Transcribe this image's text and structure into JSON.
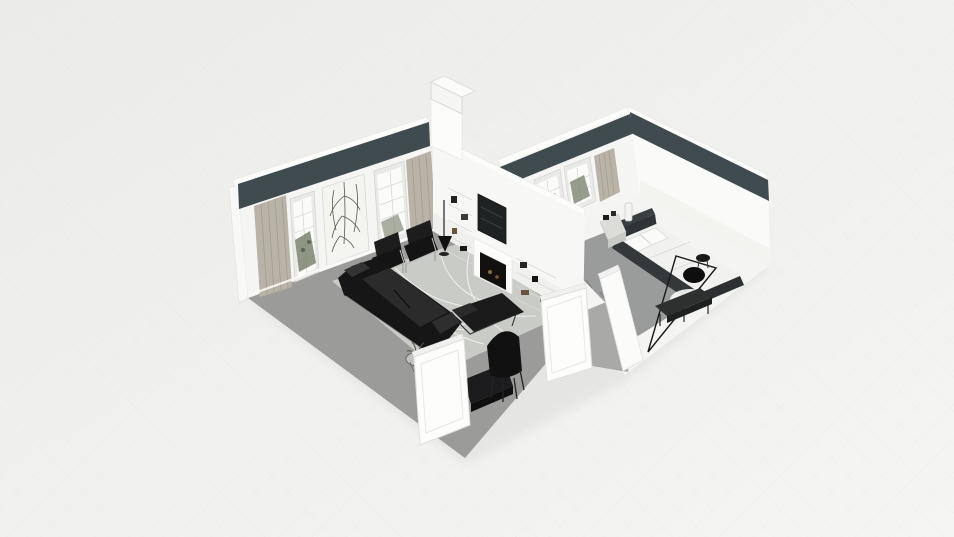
{
  "app": {
    "name": "3d-floorplan-viewer",
    "view_mode": "dollhouse-orbit-view"
  },
  "scene": {
    "rooms": [
      {
        "name": "living-room",
        "floor": "gray",
        "features": [
          "french-windows",
          "beige-curtains",
          "botanical-art-panel",
          "dark-upper-wall-band",
          "media-wall-with-fireplace",
          "wall-tv",
          "built-in-bookshelves",
          "chimney-column"
        ],
        "furniture": [
          "black-leather-sofa",
          "black-armchair",
          "black-armchair",
          "black-chaise-lounge",
          "floor-lamp",
          "wire-side-table-with-plant",
          "black-desk-chair",
          "black-low-cabinet",
          "white-door",
          "white-door",
          "marble-pattern-area-rug"
        ]
      },
      {
        "name": "bedroom",
        "floor": "white",
        "features": [
          "french-windows",
          "beige-curtain",
          "dark-upper-wall-band",
          "gray-carpet"
        ],
        "furniture": [
          "platform-bed-dark-frame",
          "white-pillows",
          "nightstand-with-vase",
          "arc-floor-lamp",
          "foot-bench",
          "round-white-rug",
          "white-door-stub"
        ]
      }
    ]
  },
  "colors": {
    "bg_top": "#ebebe9",
    "bg_bottom": "#f5f5f3",
    "grid_line": "#e2e2e0",
    "shadow": "#dcdcda",
    "wall_white": "#f5f5f3",
    "wall_white2": "#fafaf8",
    "wall_top": "#fcfcfa",
    "band_dark": "#3f4b4f",
    "floor_gray": "#9b9b99",
    "hallway_gray": "#a9a9a7",
    "rug": "#c8cbc6",
    "rug_vein": "#ededea",
    "bedroom_floor": "#f4f4f2",
    "carpet_gray": "#9a9c9c",
    "curtain": "#b8b3a6",
    "curtain_stripe": "#a49f91",
    "window_frame": "#e9e9e7",
    "glass": "#fbfbfa",
    "plant_green": "#757d68",
    "art_dark": "#565b4e",
    "black_furniture": "#161616",
    "furniture_highlight": "#2b2b2b",
    "chrome": "#b9b9b9",
    "tv_screen": "#1f2324",
    "firebox": "#121110",
    "ember": "#8a6a3c",
    "bed_frame": "#394042",
    "bedding": "#f1f1ef",
    "door_white": "#fdfdfc",
    "door_edge": "#dededc"
  }
}
